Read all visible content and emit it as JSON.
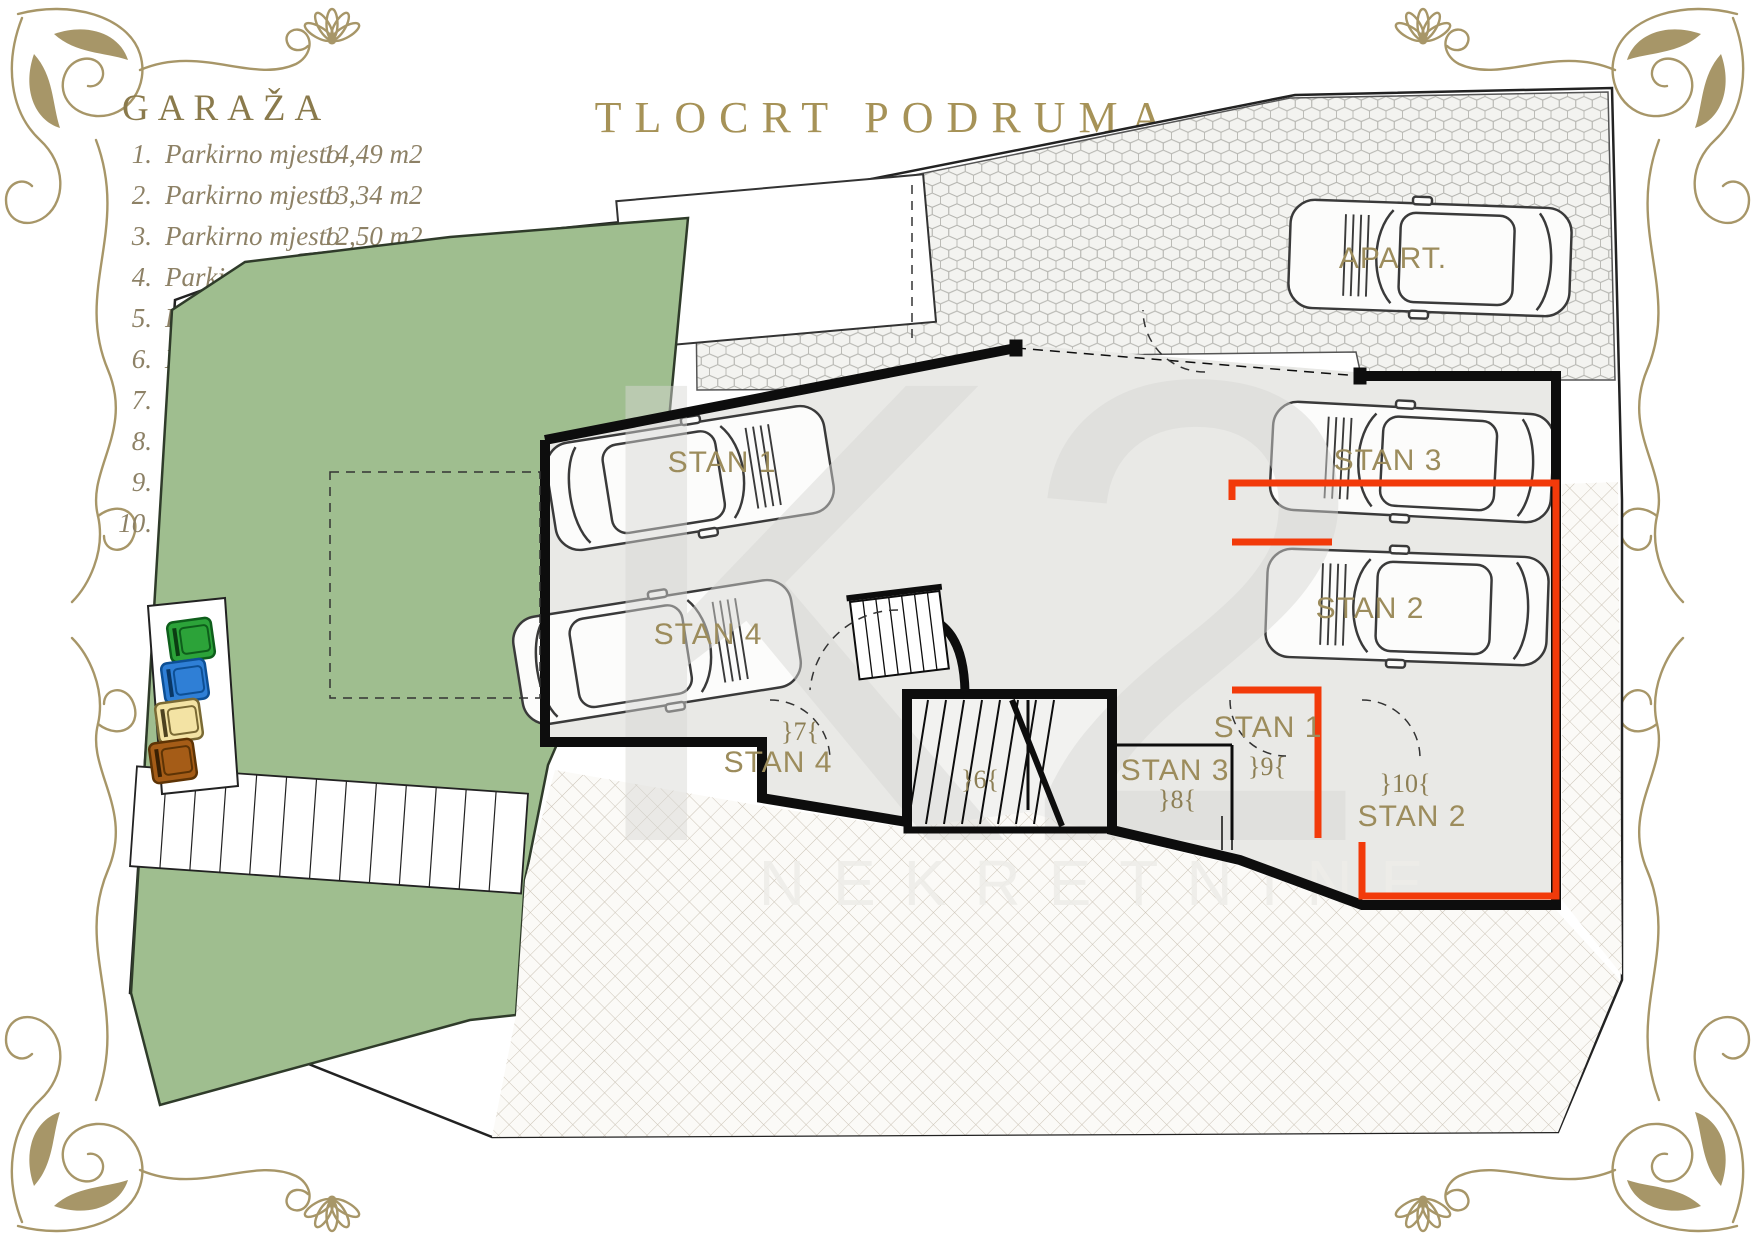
{
  "title": "TLOCRT PODRUMA",
  "legend": {
    "heading": "GARAŽA",
    "items": [
      {
        "num": "1.",
        "label": "Parkirno mjesto",
        "area": "14,49 m2"
      },
      {
        "num": "2.",
        "label": "Parkirno mjesto",
        "area": "13,34 m2"
      },
      {
        "num": "3.",
        "label": "Parkirno mjesto",
        "area": "12,50 m2"
      },
      {
        "num": "4.",
        "label": "Parkirno mjesto",
        "area": "12,50 m2"
      },
      {
        "num": "5.",
        "label": "Parkirno mjesto",
        "area": "15,16 m2"
      },
      {
        "num": "6.",
        "label": "Elektro soba",
        "area": "3,19 m2"
      },
      {
        "num": "7.",
        "label": "Ostava",
        "area": "5,23 m2"
      },
      {
        "num": "8.",
        "label": "Ostava",
        "area": "2,87 m2"
      },
      {
        "num": "9.",
        "label": "Ostava",
        "area": "4,59 m2"
      },
      {
        "num": "10.",
        "label": "Ostava",
        "area": "8,42 m2"
      }
    ]
  },
  "plan": {
    "car_labels": {
      "stan1": "STAN 1",
      "stan4": "STAN 4",
      "stan3": "STAN 3",
      "stan2": "STAN 2",
      "apart": "APART."
    },
    "room_labels": {
      "stan4": "STAN 4",
      "stan3": "STAN 3",
      "stan1": "STAN 1",
      "stan2": "STAN 2"
    },
    "room_numbers": {
      "r6": "}6{",
      "r7": "}7{",
      "r8": "}8{",
      "r9": "}9{",
      "r10": "}10{"
    }
  },
  "watermark": {
    "logo": "K2",
    "text": "NEKRETNINE"
  },
  "colors": {
    "accent_gold": "#a69257",
    "ornament_gold": "#a79668",
    "garden_green": "#9fbe8f",
    "highlight_red": "#f23a0a",
    "bins": [
      "#2ca339",
      "#2f7fd6",
      "#f3e3a4",
      "#a55c17"
    ]
  }
}
